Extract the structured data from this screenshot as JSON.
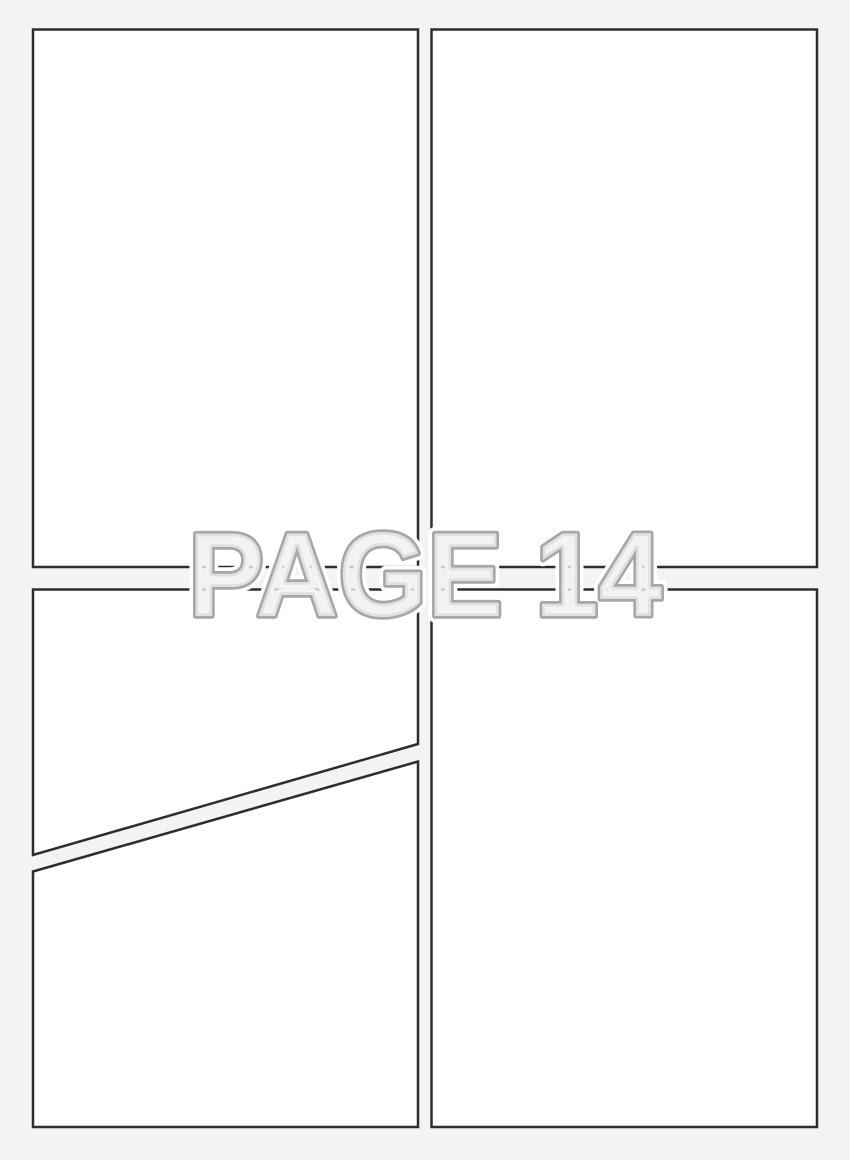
{
  "watermark": {
    "text": "PAGE 14"
  },
  "colors": {
    "page_background": "#f3f3f3",
    "panel_fill": "#ffffff",
    "panel_border": "#2d2d2d",
    "watermark_fill": "#f0f0f0",
    "watermark_outline": "#a7a7a7",
    "watermark_halo": "#ffffff"
  }
}
